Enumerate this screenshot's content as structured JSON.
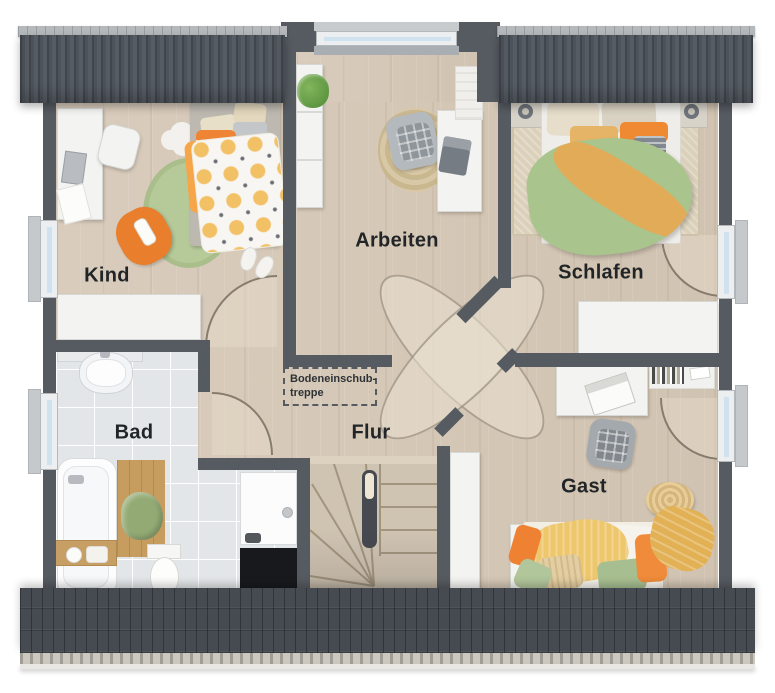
{
  "plan_type": "floor-plan",
  "rooms": {
    "kind": {
      "label": "Kind"
    },
    "arbeiten": {
      "label": "Arbeiten"
    },
    "schlafen": {
      "label": "Schlafen"
    },
    "bad": {
      "label": "Bad"
    },
    "flur": {
      "label": "Flur"
    },
    "gast": {
      "label": "Gast"
    }
  },
  "annotation": {
    "line1": "Bodeneinschub-",
    "line2": "treppe"
  },
  "colors": {
    "roof": "#4a5056",
    "roof_ridge": "#b5b9bc",
    "wall": "#565b61",
    "floor_wood": "#d5c7b6",
    "floor_tile": "#e3e6e8",
    "accent_orange": "#ee8534",
    "accent_green": "#a9c48c",
    "accent_mustard": "#e2ab57",
    "rug_green": "#b6ca99"
  }
}
